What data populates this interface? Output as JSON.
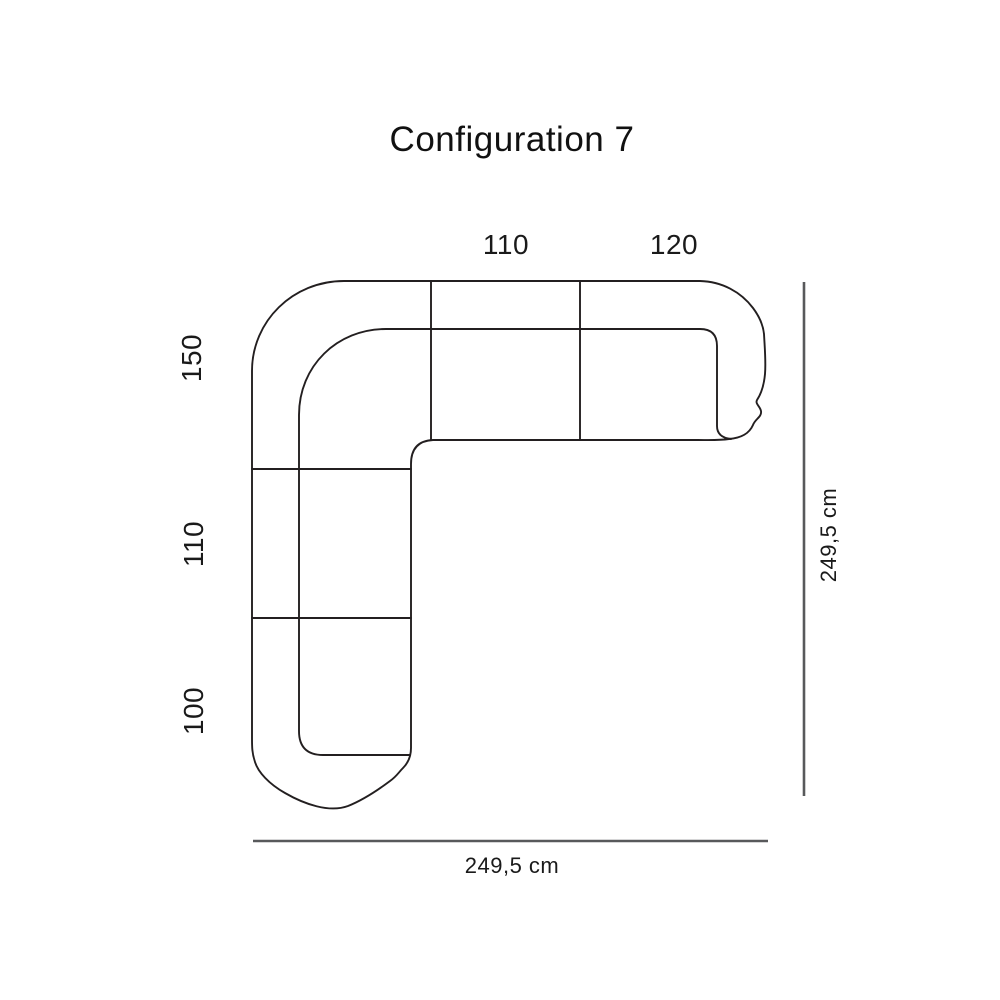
{
  "page": {
    "title": "Configuration 7"
  },
  "diagram": {
    "type": "corner-sofa-top-view-dimension-diagram",
    "modules_top": [
      {
        "label": "110"
      },
      {
        "label": "120"
      }
    ],
    "modules_left": [
      {
        "label": "150"
      },
      {
        "label": "110"
      },
      {
        "label": "100"
      }
    ],
    "overall_depth_label": "249,5 cm",
    "overall_width_label": "249,5 cm"
  },
  "colors": {
    "background": "#ffffff",
    "sofa_outline": "#231f20",
    "dimension_line": "#58595b",
    "text": "#1a1a1a"
  }
}
